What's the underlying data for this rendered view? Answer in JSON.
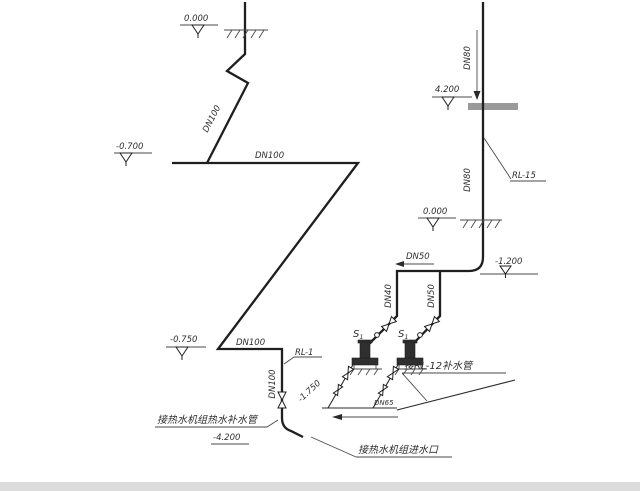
{
  "colors": {
    "line": "#1f1f1f",
    "thin_line": "#4a4a4a",
    "slab": "#9a9a9a",
    "background": "#ffffff"
  },
  "left": {
    "elev_ground": "0.000",
    "elev_offset": "-0.700",
    "dn_diagonal": "DN100",
    "dn_upper": "DN100",
    "elev_branch": "-0.750",
    "dn_lower": "DN100",
    "riser": "RL-1",
    "dn_vertical": "DN100",
    "elev_diagonal": "-1.750",
    "note_makeup": "接热水机组热水补水管",
    "elev_outlet": "-4.200"
  },
  "right": {
    "dn_top": "DN80",
    "elev_floor": "4.200",
    "riser": "RL-15",
    "dn_mid": "DN80",
    "elev_ground": "0.000",
    "dn_header": "DN50",
    "elev_header": "-1.200",
    "dn_drop_left": "DN40",
    "dn_drop_right": "DN50",
    "pumps": [
      {
        "tag": "S",
        "sub": "1"
      },
      {
        "tag": "S",
        "sub": "1"
      }
    ],
    "note_makeup_riser": "接RL-12补水管",
    "dn_suction": "DN65",
    "note_inlet": "接热水机组进水口"
  }
}
